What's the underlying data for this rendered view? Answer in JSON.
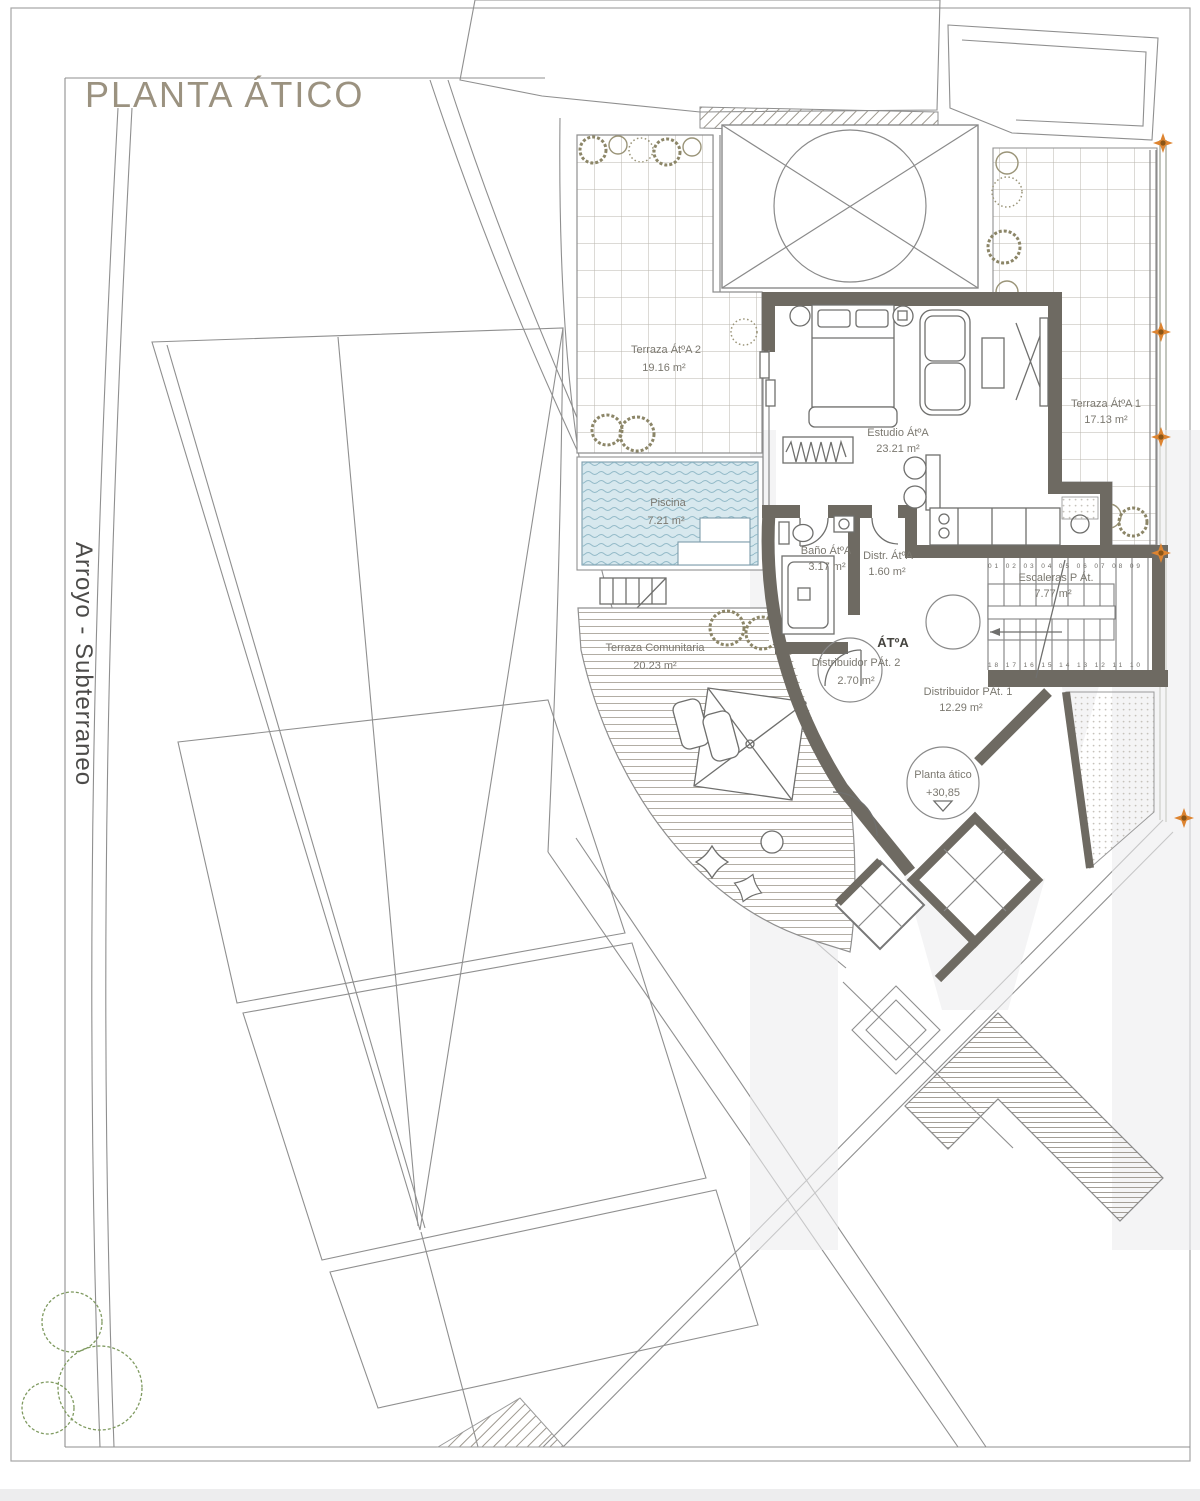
{
  "page": {
    "title": "PLANTA ÁTICO",
    "street_label": "Arroyo - Subterraneo"
  },
  "unit_tag": "ÁTºA",
  "rooms": {
    "terraza_atico_2": {
      "name": "Terraza ÁtºA 2",
      "area": "19.16 m²"
    },
    "piscina": {
      "name": "Piscina",
      "area": "7.21 m²"
    },
    "estudio": {
      "name": "Estudio ÁtºA",
      "area": "23.21 m²"
    },
    "terraza_atico_1": {
      "name": "Terraza ÁtºA 1",
      "area": "17.13 m²"
    },
    "bano": {
      "name": "Baño ÁtºA",
      "area": "3.17 m²"
    },
    "distribuidor_atico": {
      "name": "Distr. ÁtºA",
      "area": "1.60 m²"
    },
    "escaleras": {
      "name": "Escaleras P Át.",
      "area": "7.77 m²"
    },
    "distribuidor_pat_2": {
      "name": "Distribuidor PÁt. 2",
      "area": "2.70 m²"
    },
    "distribuidor_pat_1": {
      "name": "Distribuidor PÁt. 1",
      "area": "12.29 m²"
    },
    "terraza_comunitaria": {
      "name": "Terraza Comunitaria",
      "area": "20.23 m²"
    }
  },
  "level_marker": {
    "floor": "Planta ático",
    "level": "+30,85"
  },
  "stairs": {
    "top_steps": "01 02 03 04 05 06 07 08 09",
    "bottom_steps": "18 17 16 15 14 13 12 11 10"
  },
  "colors": {
    "wall": "#6e6a62",
    "accent_marker": "#dd8430",
    "water": "#d7e8ee",
    "title": "#9b9280"
  }
}
